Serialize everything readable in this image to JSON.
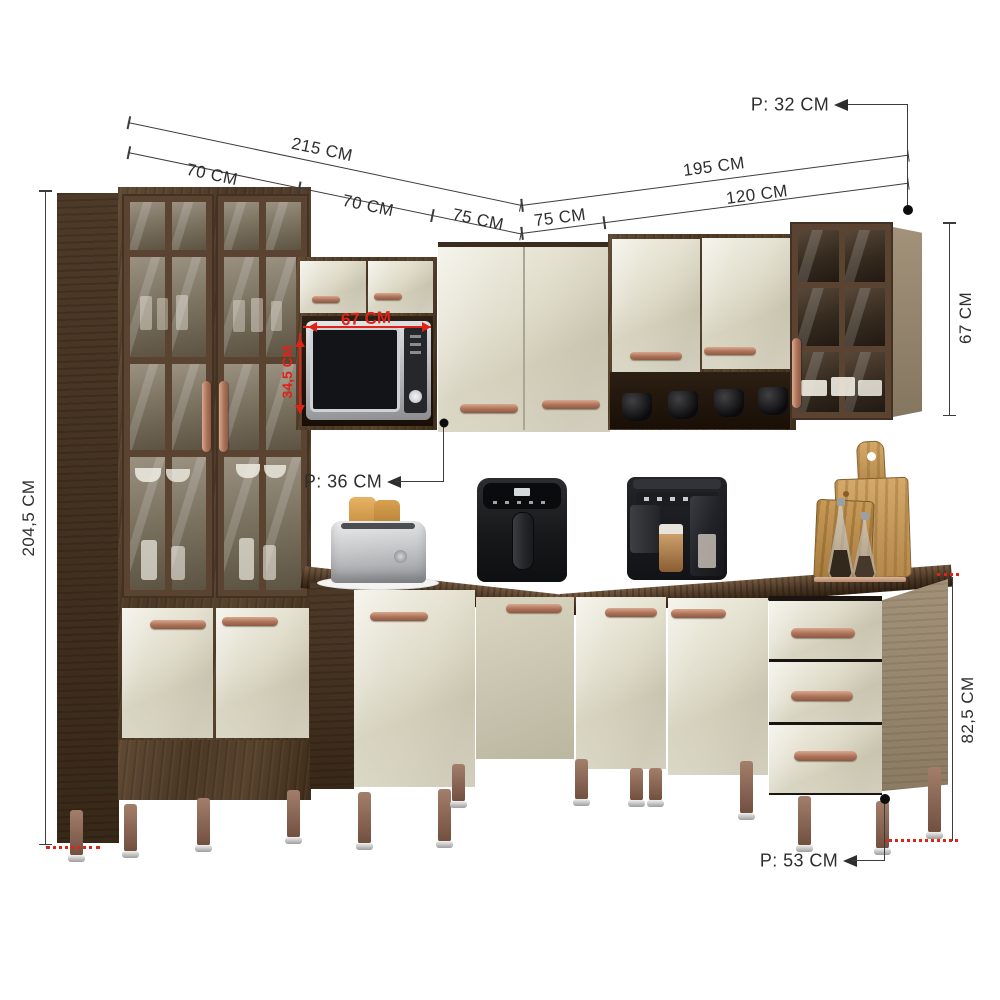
{
  "title": "modular-corner-kitchen-cabinet-set-with-dimensions",
  "colors": {
    "background": "#ffffff",
    "dimension_line": "#3c3c3c",
    "dimension_text": "#2e2e2e",
    "annotation_red": "#e02318",
    "dark_wood": "#55412e",
    "cream_panel": "#dcd7c4",
    "copper_handle": "#b8806a",
    "countertop_wood": "#4a3625",
    "side_panel_gray": "#97896f",
    "leg_bronze": "#8a6a59"
  },
  "dimensions": {
    "wall_depth_top": "P: 32 CM",
    "left_run_total": "215 CM",
    "left_run_segment_1": "70 CM",
    "left_run_segment_2": "70 CM",
    "left_run_segment_3": "75 CM",
    "right_run_segment_1": "75 CM",
    "right_run_total": "195 CM",
    "right_run_segment_2": "120 CM",
    "cabinet_total_height": "204,5 CM",
    "wall_cabinet_height": "67 CM",
    "microwave_niche_width": "67 CM",
    "microwave_niche_height": "34,5 CM",
    "wall_cabinet_depth": "P: 36 CM",
    "base_cabinet_height": "82,5 CM",
    "base_cabinet_depth": "P: 53 CM"
  }
}
